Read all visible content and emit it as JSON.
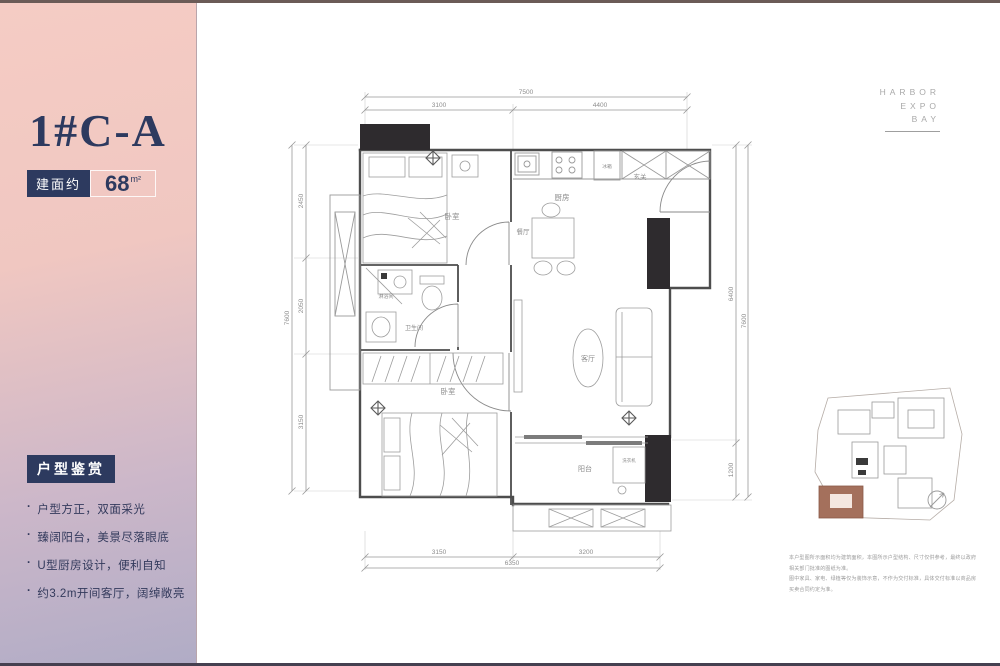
{
  "left_panel": {
    "accent_color": "#2d3a5f",
    "gradient_top": "#f5ccc4",
    "gradient_bottom": "#b0acc6",
    "unit_name": "1#C-A",
    "area_prefix": "建面约",
    "area_value": "68",
    "area_unit": "m²",
    "section_title": "户型鉴赏",
    "features": [
      "户型方正，双面采光",
      "臻阔阳台，美景尽落眼底",
      "U型厨房设计，便利自知",
      "约3.2m开间客厅，阔绰敞亮"
    ]
  },
  "brand": {
    "lines": [
      "HARBOR",
      "EXPO",
      "BAY"
    ],
    "color": "#a9a9a9"
  },
  "floor_plan": {
    "labels": {
      "bedroom1": "卧室",
      "kitchen": "厨房",
      "dining": "餐厅",
      "fridge": "冰箱",
      "entry": "玄关",
      "shower": "淋浴间",
      "bathroom": "卫生间",
      "bedroom2": "卧室",
      "living": "客厅",
      "balcony": "阳台",
      "washer": "洗衣机"
    },
    "dimensions": {
      "top": {
        "total": "7500",
        "segments": [
          "3100",
          "4400"
        ]
      },
      "left": {
        "total": "7600",
        "segments": [
          "2450",
          "2050",
          "3150"
        ]
      },
      "right": {
        "total": "7600",
        "segments": [
          "6400",
          "1200"
        ]
      },
      "bottom": {
        "total": "6350",
        "segments": [
          "3150",
          "3200"
        ]
      }
    }
  },
  "site_plan": {
    "highlight_color": "#a4705c"
  },
  "disclaimer": {
    "lines": [
      "本户型图所示面积均为建筑面积，本图所示户型结构、尺寸仅供参考，最终以政府相关部门批准的图纸为准。",
      "图中家具、家电、绿植等仅为装饰示意，不作为交付标准，具体交付标准以商品房买卖合同约定为准。"
    ]
  }
}
